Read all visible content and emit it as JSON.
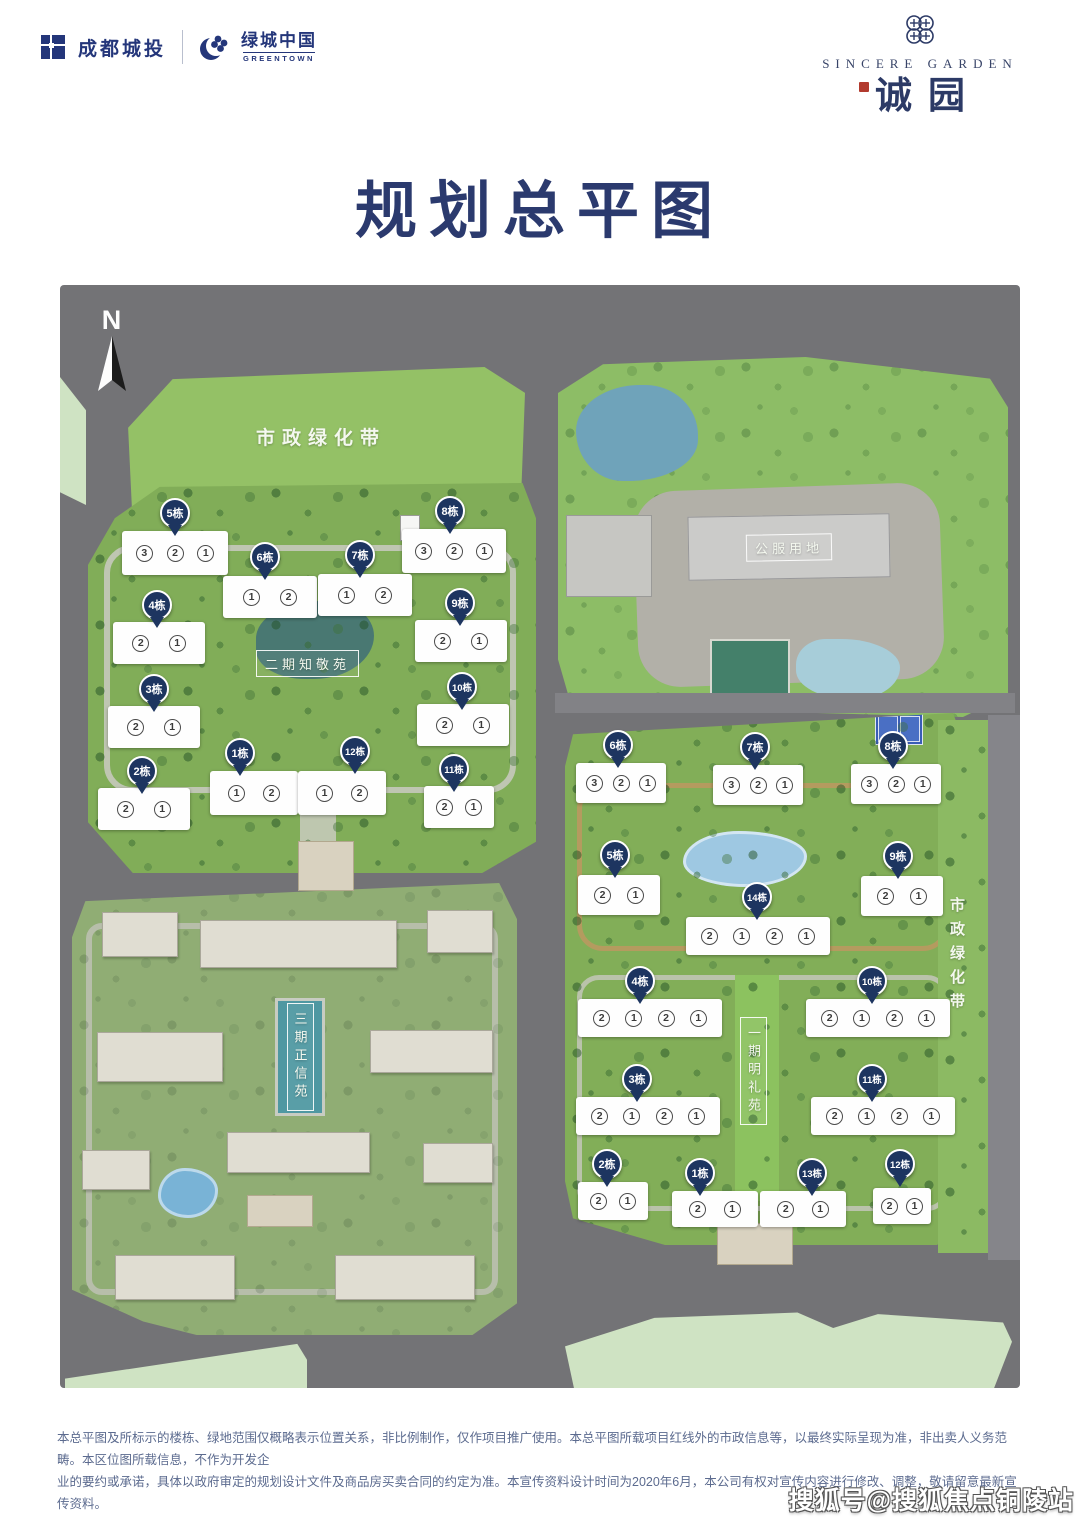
{
  "header": {
    "brand_left": {
      "name1": "成都城投",
      "name2": "绿城中国",
      "sub2": "GREENTOWN"
    },
    "brand_right": {
      "en": "SINCERE GARDEN",
      "cn": "诚园"
    }
  },
  "title": "规划总平图",
  "map": {
    "north_label": "N",
    "areas": {
      "green_belt_top": "市政绿化带",
      "green_belt_right": "市政绿化带",
      "public_service": "公服用地",
      "phase2_name": "二期知敬苑",
      "phase1_name": "一期明礼苑",
      "phase3_name": "三期正信苑"
    },
    "phase2_buildings": [
      {
        "label": "5栋",
        "pin": [
          115,
          228
        ],
        "box": [
          62,
          246,
          106,
          44
        ],
        "units": [
          "3",
          "2",
          "1"
        ]
      },
      {
        "label": "8栋",
        "pin": [
          390,
          226
        ],
        "box": [
          342,
          244,
          104,
          44
        ],
        "units": [
          "3",
          "2",
          "1"
        ]
      },
      {
        "label": "6栋",
        "pin": [
          205,
          272
        ],
        "box": [
          163,
          291,
          94,
          42
        ],
        "units": [
          "1",
          "2"
        ]
      },
      {
        "label": "7栋",
        "pin": [
          300,
          270
        ],
        "box": [
          258,
          289,
          94,
          42
        ],
        "units": [
          "1",
          "2"
        ]
      },
      {
        "label": "4栋",
        "pin": [
          97,
          320
        ],
        "box": [
          53,
          337,
          92,
          42
        ],
        "units": [
          "2",
          "1"
        ]
      },
      {
        "label": "9栋",
        "pin": [
          400,
          318
        ],
        "box": [
          355,
          335,
          92,
          42
        ],
        "units": [
          "2",
          "1"
        ]
      },
      {
        "label": "3栋",
        "pin": [
          94,
          404
        ],
        "box": [
          48,
          421,
          92,
          42
        ],
        "units": [
          "2",
          "1"
        ]
      },
      {
        "label": "10栋",
        "pin": [
          402,
          402
        ],
        "box": [
          357,
          419,
          92,
          42
        ],
        "units": [
          "2",
          "1"
        ]
      },
      {
        "label": "2栋",
        "pin": [
          82,
          486
        ],
        "box": [
          38,
          503,
          92,
          42
        ],
        "units": [
          "2",
          "1"
        ]
      },
      {
        "label": "1栋",
        "pin": [
          180,
          468
        ],
        "box": [
          150,
          486,
          88,
          44
        ],
        "units": [
          "1",
          "2"
        ]
      },
      {
        "label": "12栋",
        "pin": [
          295,
          466
        ],
        "box": [
          238,
          486,
          88,
          44
        ],
        "units": [
          "1",
          "2"
        ]
      },
      {
        "label": "11栋",
        "pin": [
          394,
          484
        ],
        "box": [
          364,
          501,
          70,
          42
        ],
        "units": [
          "2",
          "1"
        ]
      }
    ],
    "phase1_buildings": [
      {
        "label": "6栋",
        "pin": [
          558,
          460
        ],
        "box": [
          516,
          478,
          90,
          40
        ],
        "units": [
          "3",
          "2",
          "1"
        ]
      },
      {
        "label": "7栋",
        "pin": [
          695,
          462
        ],
        "box": [
          653,
          480,
          90,
          40
        ],
        "units": [
          "3",
          "2",
          "1"
        ]
      },
      {
        "label": "8栋",
        "pin": [
          833,
          461
        ],
        "box": [
          791,
          479,
          90,
          40
        ],
        "units": [
          "3",
          "2",
          "1"
        ]
      },
      {
        "label": "5栋",
        "pin": [
          555,
          570
        ],
        "box": [
          518,
          590,
          82,
          40
        ],
        "units": [
          "2",
          "1"
        ]
      },
      {
        "label": "9栋",
        "pin": [
          838,
          571
        ],
        "box": [
          801,
          591,
          82,
          40
        ],
        "units": [
          "2",
          "1"
        ]
      },
      {
        "label": "14栋",
        "pin": [
          697,
          612
        ],
        "box": [
          626,
          632,
          144,
          38
        ],
        "units": [
          "2",
          "1",
          "2",
          "1"
        ]
      },
      {
        "label": "4栋",
        "pin": [
          580,
          696
        ],
        "box": [
          518,
          714,
          144,
          38
        ],
        "units": [
          "2",
          "1",
          "2",
          "1"
        ]
      },
      {
        "label": "10栋",
        "pin": [
          812,
          696
        ],
        "box": [
          746,
          714,
          144,
          38
        ],
        "units": [
          "2",
          "1",
          "2",
          "1"
        ]
      },
      {
        "label": "3栋",
        "pin": [
          577,
          794
        ],
        "box": [
          516,
          812,
          144,
          38
        ],
        "units": [
          "2",
          "1",
          "2",
          "1"
        ]
      },
      {
        "label": "11栋",
        "pin": [
          812,
          794
        ],
        "box": [
          751,
          812,
          144,
          38
        ],
        "units": [
          "2",
          "1",
          "2",
          "1"
        ]
      },
      {
        "label": "2栋",
        "pin": [
          547,
          879
        ],
        "box": [
          518,
          897,
          70,
          38
        ],
        "units": [
          "2",
          "1"
        ]
      },
      {
        "label": "1栋",
        "pin": [
          640,
          888
        ],
        "box": [
          612,
          906,
          86,
          36
        ],
        "units": [
          "2",
          "1"
        ]
      },
      {
        "label": "13栋",
        "pin": [
          752,
          888
        ],
        "box": [
          700,
          906,
          86,
          36
        ],
        "units": [
          "2",
          "1"
        ]
      },
      {
        "label": "12栋",
        "pin": [
          840,
          879
        ],
        "box": [
          813,
          903,
          58,
          36
        ],
        "units": [
          "2",
          "1"
        ]
      }
    ]
  },
  "disclaimer": {
    "lines": [
      "本总平图及所标示的楼栋、绿地范围仅概略表示位置关系，非比例制作，仅作项目推广使用。本总平图所载项目红线外的市政信息等，以最终实际呈现为准，非出卖人义务范畴。本区位图所载信息，不作为开发企",
      "业的要约或承诺，具体以政府审定的规划设计文件及商品房买卖合同的约定为准。本宣传资料设计时间为2020年6月，本公司有权对宣传内容进行修改、调整，敬请留意最新宣传资料。"
    ]
  },
  "watermark": "搜狐号@搜狐焦点铜陵站",
  "colors": {
    "brand_navy": "#24367a",
    "pin_navy": "#1d3560",
    "title_navy": "#2b3a6e",
    "map_road_gray": "#737376",
    "parcel_green": "#94c166",
    "pale_green": "#cfe3c3",
    "disclaimer_text": "#5c6b8f",
    "seal_red": "#b23a2e"
  }
}
